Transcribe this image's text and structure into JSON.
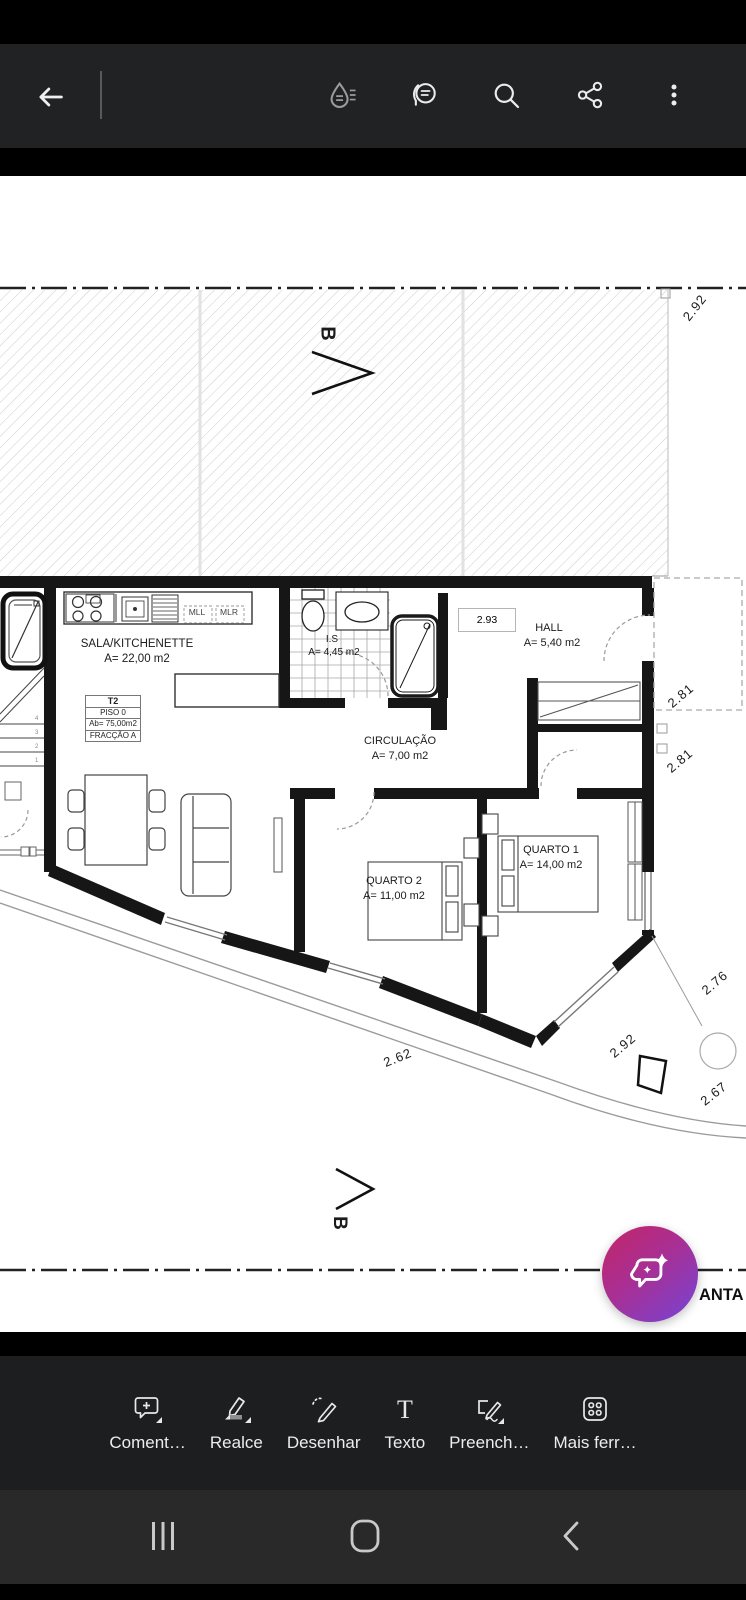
{
  "app_bar": {
    "icons": {
      "back": "back-arrow",
      "liquid_mode": "liquid-mode-drop",
      "comments": "view-comments",
      "search": "search",
      "share": "share",
      "overflow": "more-options"
    }
  },
  "plan": {
    "section_label": "B",
    "dim_box": "2.93",
    "dims": {
      "d1": "2.92",
      "d2": "2.81",
      "d3": "2.81",
      "d4": "2.76",
      "d5": "2.92",
      "d6": "2.67",
      "d7": "2.62"
    },
    "kitchen": {
      "mll": "MLL",
      "mlr": "MLR"
    },
    "info_table": {
      "row1": "T2",
      "row2": "PISO 0",
      "row3": "Ab= 75,00m2",
      "row4": "FRACÇÃO A"
    },
    "rooms": {
      "sala": {
        "name": "SALA/KITCHENETTE",
        "area": "A= 22,00 m2"
      },
      "is": {
        "name": "I.S",
        "area": "A= 4,45 m2"
      },
      "hall": {
        "name": "HALL",
        "area": "A= 5,40 m2"
      },
      "circulacao": {
        "name": "CIRCULAÇÃO",
        "area": "A= 7,00 m2"
      },
      "quarto1": {
        "name": "QUARTO 1",
        "area": "A= 14,00 m2"
      },
      "quarto2": {
        "name": "QUARTO 2",
        "area": "A= 11,00 m2"
      }
    },
    "stairs": {
      "n1": "1",
      "n2": "2",
      "n3": "3",
      "n4": "4"
    },
    "partial_title": "ANTA"
  },
  "fab": {
    "icon": "ai-assistant-sparkle-chat"
  },
  "tools_bar": {
    "items": [
      {
        "label": "Coment…"
      },
      {
        "label": "Realce"
      },
      {
        "label": "Desenhar"
      },
      {
        "label": "Texto"
      },
      {
        "label": "Preench…"
      },
      {
        "label": "Mais ferr…"
      }
    ]
  },
  "nav_bar": {
    "icons": {
      "recents": "recents",
      "home": "home",
      "back": "back"
    }
  }
}
